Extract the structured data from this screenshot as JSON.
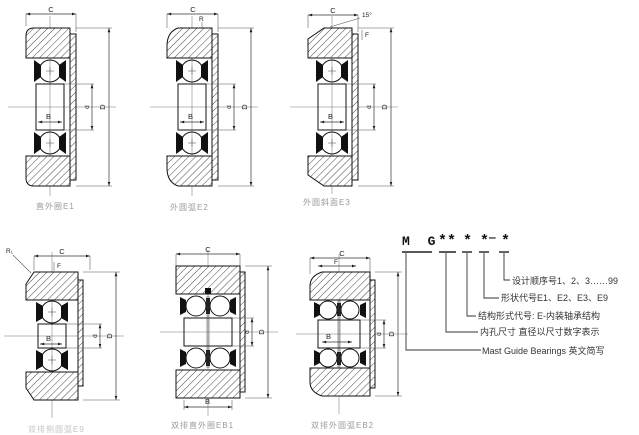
{
  "figures": {
    "e1": {
      "caption": "直外圈E1",
      "c": "C",
      "d_outer": "D",
      "d_inner": "d",
      "b": "B"
    },
    "e2": {
      "caption": "外圆弧E2",
      "c": "C",
      "d_outer": "D",
      "d_inner": "d",
      "b": "B",
      "r": "R"
    },
    "e3": {
      "caption": "外圆斜面E3",
      "c": "C",
      "d_outer": "D",
      "d_inner": "d",
      "b": "B",
      "angle": "15°",
      "f": "F"
    },
    "e9": {
      "caption": "双排侧圆弧E9",
      "c": "C",
      "d_outer": "D",
      "d_inner": "d",
      "b": "B",
      "r1": "R₁",
      "f": "F"
    },
    "eb1": {
      "caption": "双排直外圈EB1",
      "c": "C",
      "d_outer": "D",
      "d_inner": "d",
      "b": "B"
    },
    "eb2": {
      "caption": "双排外圆弧EB2",
      "c": "C",
      "d_outer": "D",
      "d_inner": "d",
      "b": "B",
      "f": "F"
    }
  },
  "code_panel": {
    "prefix": "M G",
    "bore_stars": "**",
    "structure_star": "*",
    "shape_star": "*",
    "dash": "—",
    "seq_star": "*",
    "lines": {
      "seq": "设计顺序号1、2、3……99",
      "shape": "形状代号E1、E2、E3、E9",
      "structure": "结构形式代号: E-内装轴承结构",
      "bore": "内孔尺寸 直径以尺寸数字表示",
      "brand": "Mast Guide Bearings 英文简写"
    }
  }
}
